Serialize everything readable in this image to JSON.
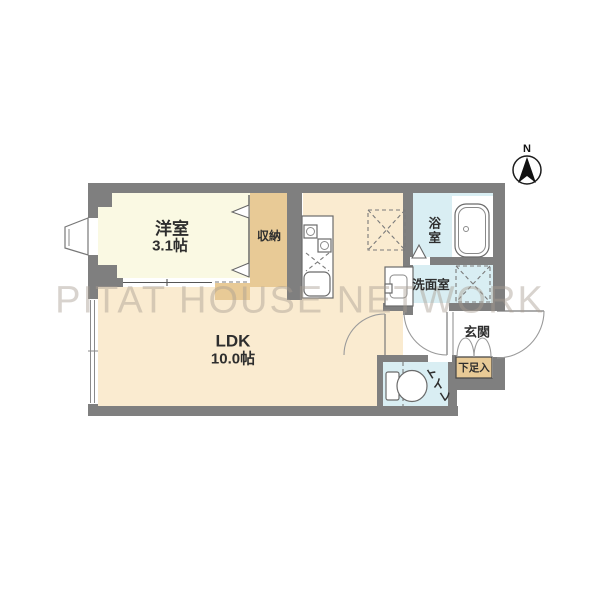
{
  "watermark": "PITAT HOUSE NETWORK",
  "compass": {
    "label": "N"
  },
  "rooms": {
    "western": {
      "label": "洋室",
      "size": "3.1帖"
    },
    "ldk": {
      "label": "LDK",
      "size": "10.0帖"
    },
    "closet": {
      "label": "収納"
    },
    "bath": {
      "label": "浴室"
    },
    "washroom": {
      "label": "洗面室"
    },
    "entrance": {
      "label": "玄関"
    },
    "shoebox": {
      "label": "下足入"
    },
    "toilet": {
      "label": "トイレ"
    }
  },
  "colors": {
    "wall": "#7f7f7f",
    "western_floor": "#faf9e3",
    "ldk_floor": "#faebd0",
    "closet_fill": "#e8ca96",
    "wet_room_fill": "#d9eef3",
    "label_text": "#2e2e2e",
    "watermark_text": "rgba(168,158,147,0.45)"
  }
}
